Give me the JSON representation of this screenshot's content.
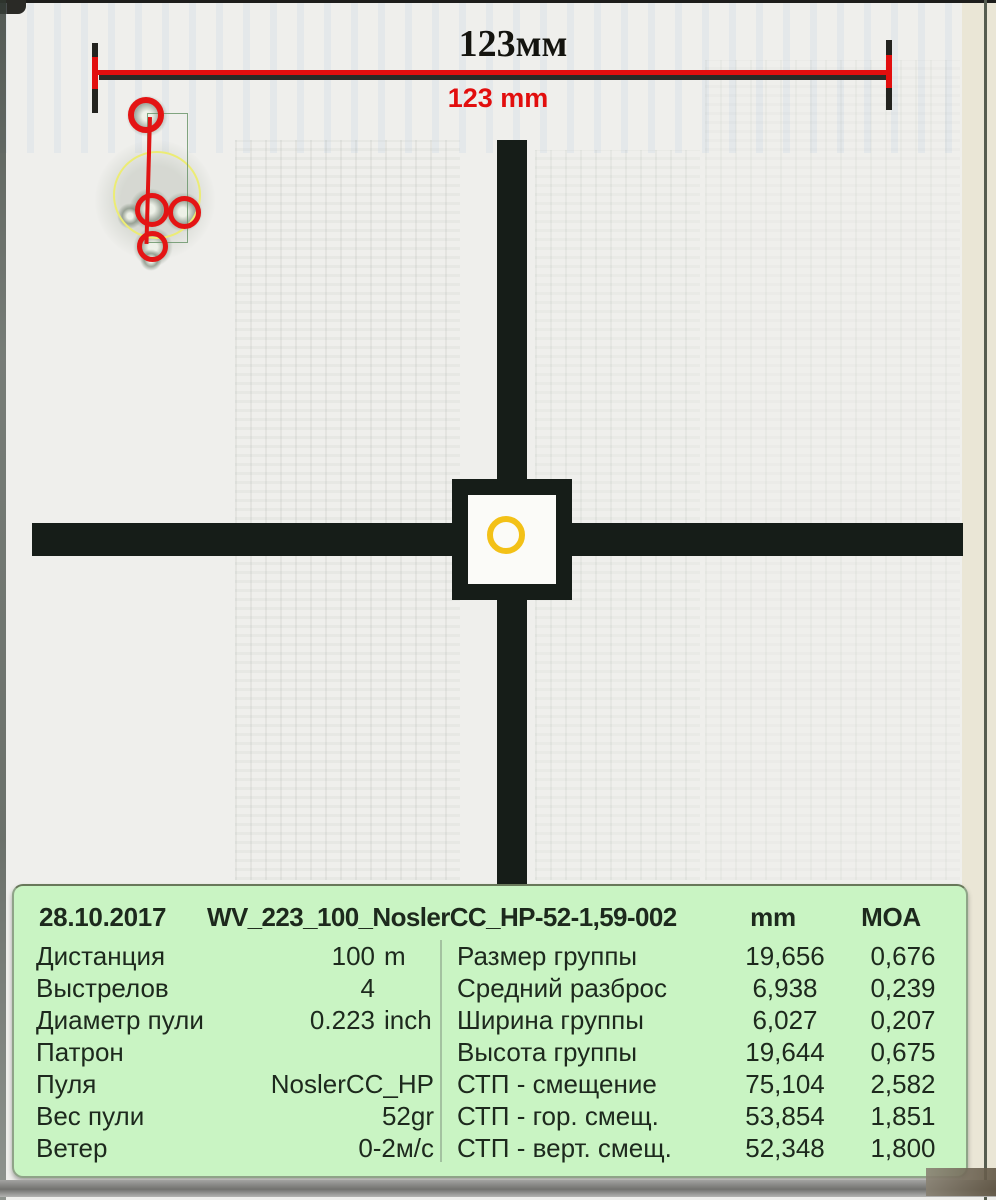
{
  "ruler": {
    "length_label_top": "123мм",
    "length_label_bottom": "123 mm"
  },
  "table": {
    "header": {
      "date": "28.10.2017",
      "session_title": "WV_223_100_NoslerCC_HP-52-1,59-002",
      "col_mm": "mm",
      "col_moa": "MOA"
    },
    "info_rows": [
      {
        "label": "Дистанция",
        "value": "100",
        "unit": "m"
      },
      {
        "label": "Выстрелов",
        "value": "4",
        "unit": " "
      },
      {
        "label": "Диаметр пули",
        "value": "0.223",
        "unit": "inch"
      },
      {
        "label": "Патрон",
        "value": "",
        "unit": ""
      },
      {
        "label": "Пуля",
        "value": "NoslerCC_HP",
        "unit": ""
      },
      {
        "label": "Вес пули",
        "value": "52gr",
        "unit": ""
      },
      {
        "label": "Ветер",
        "value": "0-2м/с",
        "unit": ""
      }
    ],
    "stat_rows": [
      {
        "label": "Размер группы",
        "mm": "19,656",
        "moa": "0,676"
      },
      {
        "label": "Средний разброс",
        "mm": "6,938",
        "moa": "0,239"
      },
      {
        "label": "Ширина группы",
        "mm": "6,027",
        "moa": "0,207"
      },
      {
        "label": "Высота группы",
        "mm": "19,644",
        "moa": "0,675"
      },
      {
        "label": "СТП - смещение",
        "mm": "75,104",
        "moa": "2,582"
      },
      {
        "label": "СТП - гор. смещ.",
        "mm": "53,854",
        "moa": "1,851"
      },
      {
        "label": "СТП - верт. смещ.",
        "mm": "52,348",
        "moa": "1,800"
      }
    ]
  },
  "colors": {
    "marker_red": "#e41414",
    "ruler_red": "#e20e0e",
    "aim_ring_yellow": "#f3c117",
    "mean_circle_yellow": "#ecec74",
    "group_box_green": "#6c966c",
    "table_bg_green": "#c9f4c3",
    "crosshair_black": "#161d18"
  },
  "shot_count": 4
}
